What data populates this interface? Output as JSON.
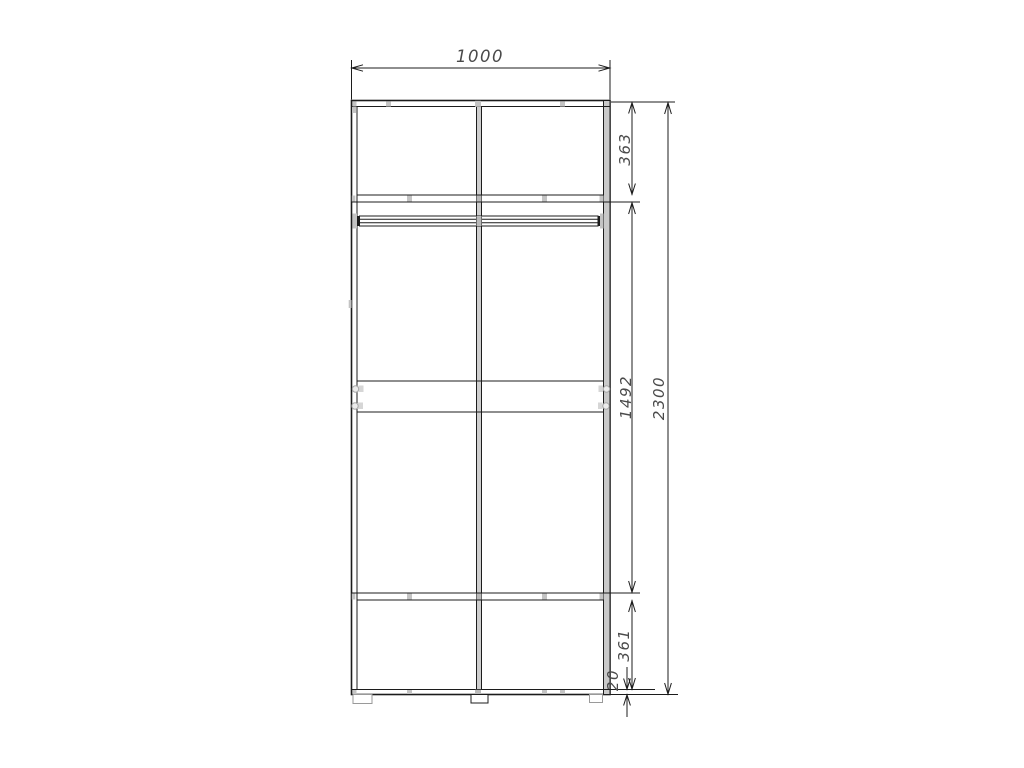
{
  "drawing": {
    "type_label": "wardrobe-front-elevation",
    "dimensions": {
      "width": "1000",
      "top_section": "363",
      "middle_section": "1492",
      "bottom_section": "361",
      "base": "20",
      "total_height": "2300"
    },
    "colors": {
      "line": "#1c1c1c",
      "panel_gray": "#c9c9c9",
      "detail_gray": "#c4c4c4",
      "dim_text": "#4a4a4a",
      "background": "#ffffff"
    }
  }
}
